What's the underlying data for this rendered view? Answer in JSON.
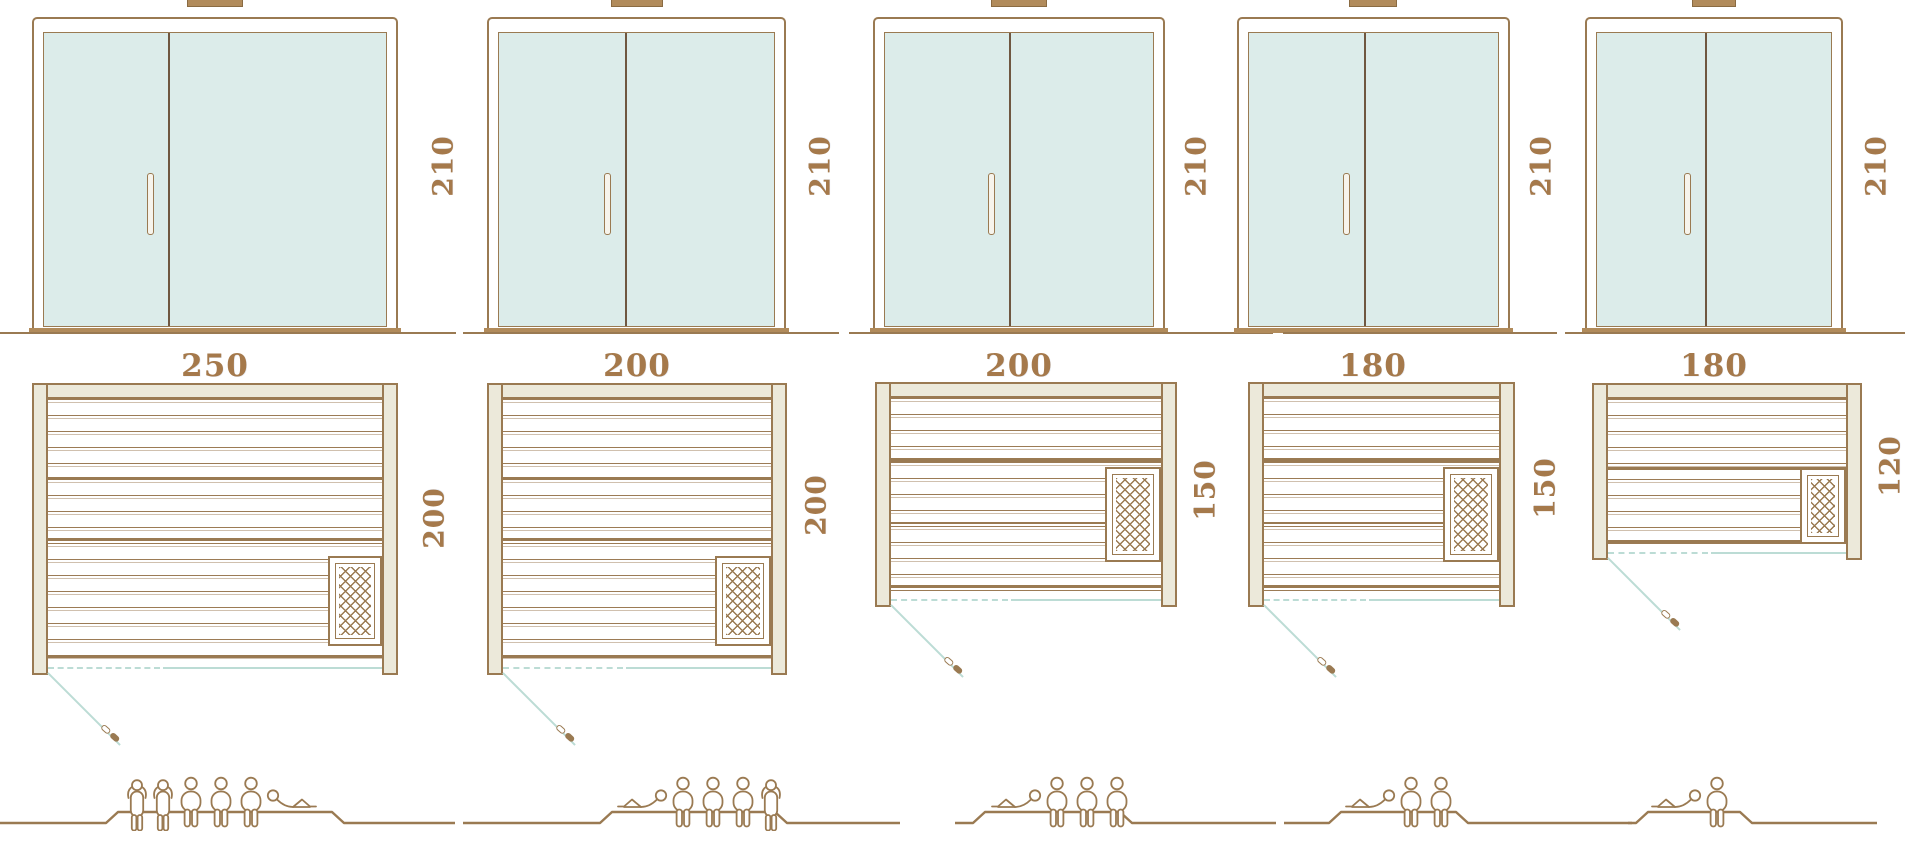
{
  "diagram": {
    "kind": "sauna-size-comparison",
    "views": [
      "front-elevation",
      "floor-plan",
      "capacity-figures"
    ]
  },
  "colors": {
    "outline_brown": "#9a7a52",
    "divider_dark_brown": "#6f5741",
    "wood_cream": "#ece9da",
    "glass_blue": "#dcecea",
    "door_swing_teal": "#bcdcd5",
    "threshold_tan": "#b18b5b",
    "dimension_text": "#a5794b"
  },
  "panels": [
    {
      "width_label": "250",
      "height_label": "210",
      "depth_label": "200",
      "capacity": 6,
      "people": [
        "standing",
        "standing",
        "sitting",
        "sitting",
        "sitting",
        "lying"
      ]
    },
    {
      "width_label": "200",
      "height_label": "210",
      "depth_label": "200",
      "capacity": 5,
      "people": [
        "lying",
        "sitting",
        "sitting",
        "sitting",
        "standing"
      ]
    },
    {
      "width_label": "200",
      "height_label": "210",
      "depth_label": "150",
      "capacity": 4,
      "people": [
        "lying",
        "sitting",
        "sitting",
        "sitting"
      ]
    },
    {
      "width_label": "180",
      "height_label": "210",
      "depth_label": "150",
      "capacity": 3,
      "people": [
        "lying",
        "sitting",
        "sitting"
      ]
    },
    {
      "width_label": "180",
      "height_label": "210",
      "depth_label": "120",
      "capacity": 2,
      "people": [
        "lying",
        "sitting"
      ]
    }
  ]
}
